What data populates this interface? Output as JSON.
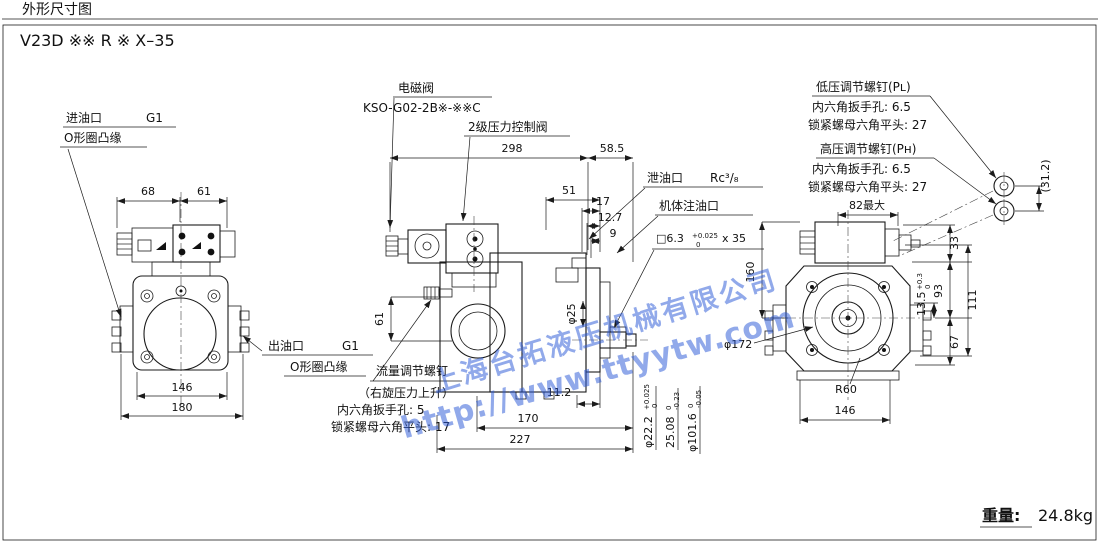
{
  "page": {
    "title": "外形尺寸图",
    "model_code": "V23D ※※ R ※ X–35",
    "weight_label": "重量:",
    "weight_value": "24.8kg",
    "line_color": "#1b1b1b"
  },
  "watermark": {
    "company": "上海台拓液压机械有限公司",
    "url": "http://www.ttyytw.com",
    "color": "#2d5ad7"
  },
  "front_view": {
    "inlet_label": "进油口",
    "inlet_thread": "G1",
    "inlet_flange_note": "O形圈凸缘",
    "outlet_label": "出油口",
    "outlet_thread": "G1",
    "outlet_flange_note": "O形圈凸缘",
    "dim_valve_left": "68",
    "dim_valve_right": "61",
    "dim_mount_width": "146",
    "dim_overall_width": "180"
  },
  "side_view": {
    "solenoid_label": "电磁阀",
    "solenoid_model": "KSO-G02-2B※-※※C",
    "pilot_label": "2级压力控制阀",
    "drain_label": "泄油口",
    "drain_thread": "Rc³/₈",
    "fill_label": "机体注油口",
    "key_spec": "□6.3",
    "key_tol_upper": "+0.025",
    "key_tol_lower": "0",
    "key_length": "x 35",
    "dim_overall_length": "298",
    "dim_rear": "58.5",
    "dim_51": "51",
    "dim_17": "17",
    "dim_12_7": "12.7",
    "dim_9": "9",
    "dim_61": "61",
    "dim_phi25": "φ25",
    "dim_11_2": "11.2",
    "dim_170": "170",
    "dim_227": "227",
    "shaft_dia": "φ22.2",
    "shaft_tol_upper": "+0.025",
    "shaft_tol_lower": "0",
    "key_height": "25.08",
    "key_height_tol_upper": "0",
    "key_height_tol_lower": "-0.23",
    "spigot_dia": "φ101.6",
    "spigot_tol_upper": "0",
    "spigot_tol_lower": "-0.05",
    "flow_screw_label": "流量调节螺钉",
    "flow_screw_note": "（右旋压力上升）",
    "flow_screw_hex": "内六角扳手孔: 5",
    "flow_screw_lock": "锁紧螺母六角平头: 17"
  },
  "rear_view": {
    "low_pressure_label": "低压调节螺钉(Pʟ)",
    "low_pressure_hex": "内六角扳手孔: 6.5",
    "low_pressure_lock": "锁紧螺母六角平头: 27",
    "high_pressure_label": "高压调节螺钉(Pʜ)",
    "high_pressure_hex": "内六角扳手孔: 6.5",
    "high_pressure_lock": "锁紧螺母六角平头: 27",
    "dim_screw_spacing": "(31.2)",
    "dim_82max": "82最大",
    "dim_33": "33",
    "dim_160": "160",
    "dim_111": "111",
    "dim_93": "93",
    "dim_13_5": "13.5",
    "dim_13_5_tol_upper": "+0.3",
    "dim_13_5_tol_lower": "0",
    "dim_67": "67",
    "dia_pilot": "φ172",
    "radius": "R60",
    "dim_146": "146"
  }
}
